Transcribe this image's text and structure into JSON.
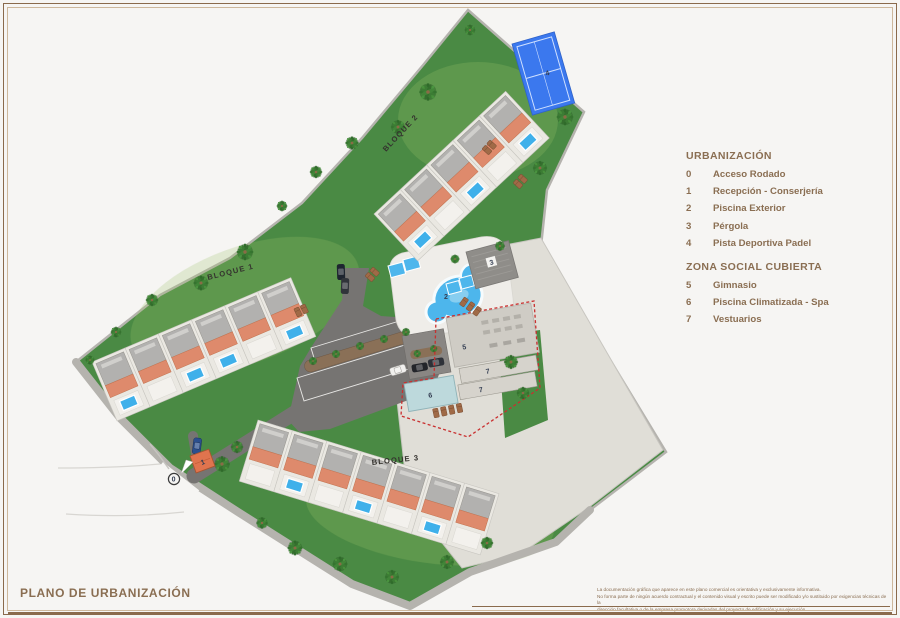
{
  "header": {
    "title": "PLANO DE URBANIZACIÓN"
  },
  "legend": {
    "urbanizacion": {
      "title": "URBANIZACIÓN",
      "items": [
        {
          "num": "0",
          "label": "Acceso Rodado"
        },
        {
          "num": "1",
          "label": "Recepción - Conserjería"
        },
        {
          "num": "2",
          "label": "Piscina Exterior"
        },
        {
          "num": "3",
          "label": "Pérgola"
        },
        {
          "num": "4",
          "label": "Pista Deportiva Padel"
        }
      ]
    },
    "zona_social": {
      "title": "ZONA SOCIAL CUBIERTA",
      "items": [
        {
          "num": "5",
          "label": "Gimnasio"
        },
        {
          "num": "6",
          "label": "Piscina Climatizada - Spa"
        },
        {
          "num": "7",
          "label": "Vestuarios"
        }
      ]
    }
  },
  "map": {
    "block_labels": {
      "bloque1": "BLOQUE 1",
      "bloque2": "BLOQUE 2",
      "bloque3": "BLOQUE 3"
    },
    "markers": {
      "m0": "0",
      "m1": "1",
      "m2": "2",
      "m3": "3",
      "m4": "4",
      "m5": "5",
      "m6": "6",
      "m7a": "7",
      "m7b": "7"
    }
  },
  "footer": {
    "disclaimer_lines": [
      "La documentación gráfica que aparece en este plano comercial es orientativa y exclusivamente informativa.",
      "No forma parte de ningún acuerdo contractual y el contenido visual y escrito puede ser modificado y/o sustituido por exigencias técnicas de la",
      "dirección facultativa o de la empresa promotora derivadas del proyecto de edificación y su ejecución."
    ]
  },
  "colors": {
    "brand_brown": "#8a6e52",
    "grass_green": "#4a8a44",
    "court_blue": "#3b78ee",
    "pool_blue": "#4db6ec",
    "terracotta": "#de8a6c",
    "social_zone_red": "#c92f2f"
  }
}
